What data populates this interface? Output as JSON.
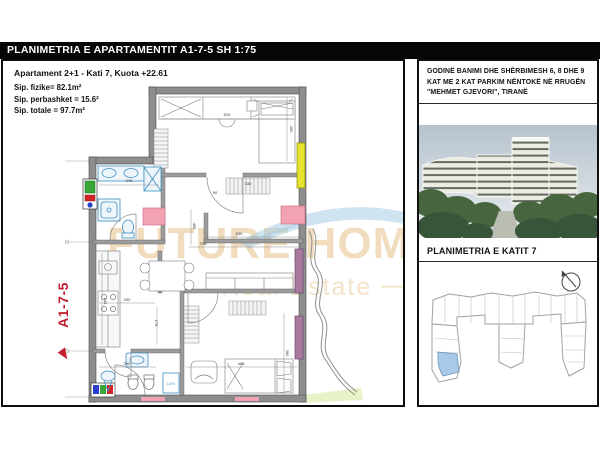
{
  "header": {
    "title": "PLANIMETRIA E APARTAMENTIT A1-7-5 SH 1:75"
  },
  "plan": {
    "title": "Apartament 2+1 - Kati 7, Kuota +22.61",
    "area_lines": [
      "Sip. fizike= 82.1m²",
      "Sip. perbashket = 15.6²",
      "Sip. totale = 97.7m²"
    ],
    "unit_label": "A1-7-5",
    "shower_label": "LxTh",
    "watermark": {
      "line1": "FUTURE HOME",
      "line2": "Real Estate",
      "dash": "—"
    },
    "dimensions": [
      {
        "text": "510",
        "x": 224,
        "y": 55,
        "rot": 0
      },
      {
        "text": "245",
        "x": 126,
        "y": 121,
        "rot": 0
      },
      {
        "text": "330",
        "x": 245,
        "y": 124,
        "rot": 0
      },
      {
        "text": "90",
        "x": 212,
        "y": 133,
        "rot": 0
      },
      {
        "text": "360",
        "x": 287,
        "y": 68,
        "rot": 90
      },
      {
        "text": "650",
        "x": 236,
        "y": 174,
        "rot": 0
      },
      {
        "text": "706",
        "x": 200,
        "y": 184,
        "rot": 0
      },
      {
        "text": "455",
        "x": 190,
        "y": 165,
        "rot": 90
      },
      {
        "text": "290",
        "x": 124,
        "y": 240,
        "rot": 0
      },
      {
        "text": "246",
        "x": 101,
        "y": 240,
        "rot": 90
      },
      {
        "text": "175",
        "x": 152,
        "y": 262,
        "rot": 90
      },
      {
        "text": "290",
        "x": 124,
        "y": 304,
        "rot": 0
      },
      {
        "text": "405",
        "x": 238,
        "y": 304,
        "rot": 0
      },
      {
        "text": "360",
        "x": 283,
        "y": 292,
        "rot": 90
      }
    ]
  },
  "info": {
    "description": "GODINË BANIMI DHE SHËRBIMESH 6, 8 DHE 9 KAT ME 2 KAT PARKIM NËNTOKË NË RRUGËN \"MEHMET GJEVORI\", TIRANË",
    "floor_title": "PLANIMETRIA E KATIT 7"
  },
  "colors": {
    "accent_red": "#c22031",
    "window_yellow": "#e6e232",
    "window_purple": "#a87aa0",
    "marker_pink": "#f2a2b2",
    "highlight_blue": "#a9c9e9",
    "wall_gray": "#8d8d8d",
    "fixture_blue": "#3b8fc4",
    "watermark_beige": "#eed9b9",
    "header_bg": "#060606"
  }
}
